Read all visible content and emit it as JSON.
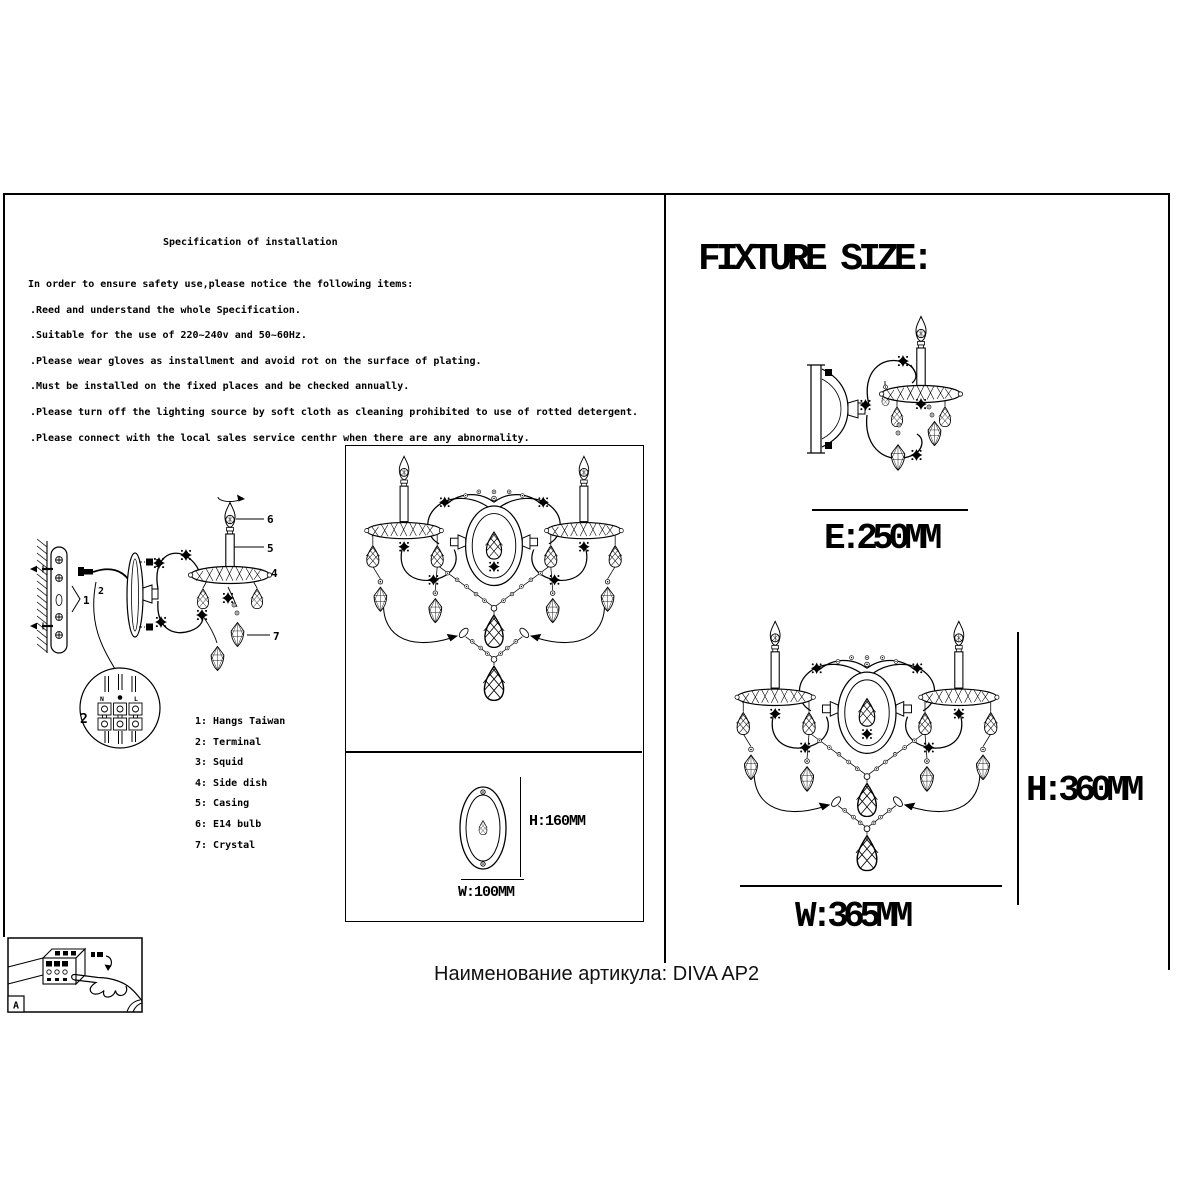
{
  "document": {
    "footer_caption": "Наименование артикула: DIVA AP2"
  },
  "left_panel": {
    "title": "Specification of installation",
    "intro": "In order to ensure safety use,please notice the following items:",
    "notices": [
      ".Reed and understand the whole Specification.",
      ".Suitable for the use of 220~240v and 50~60Hz.",
      ".Please wear gloves as installment and avoid rot on the surface of plating.",
      ".Must be installed on the fixed places and be checked annually.",
      ".Please turn off the lighting source by soft cloth as cleaning prohibited to use of rotted detergent.",
      ".Please connect with the local sales service centhr when there are any abnormality."
    ],
    "parts_list": [
      "1: Hangs Taiwan",
      "2: Terminal",
      "3: Squid",
      "4: Side dish",
      "5: Casing",
      "6: E14 bulb",
      "7: Crystal"
    ],
    "callouts": {
      "n1": "1",
      "n2": "2",
      "n3": "3",
      "n4": "4",
      "n5": "5",
      "n6": "6",
      "n7": "7",
      "screw_top": "3"
    },
    "terminal_detail": {
      "neutral": "N",
      "live": "L",
      "number": "2"
    },
    "backplate": {
      "height": "H:160MM",
      "width": "W:100MM"
    },
    "inset_corner_label": "A"
  },
  "right_panel": {
    "title": "FIXTURE SIZE:",
    "extension_dim": "E:250MM",
    "width_dim": "W:365MM",
    "height_dim": "H:360MM"
  }
}
